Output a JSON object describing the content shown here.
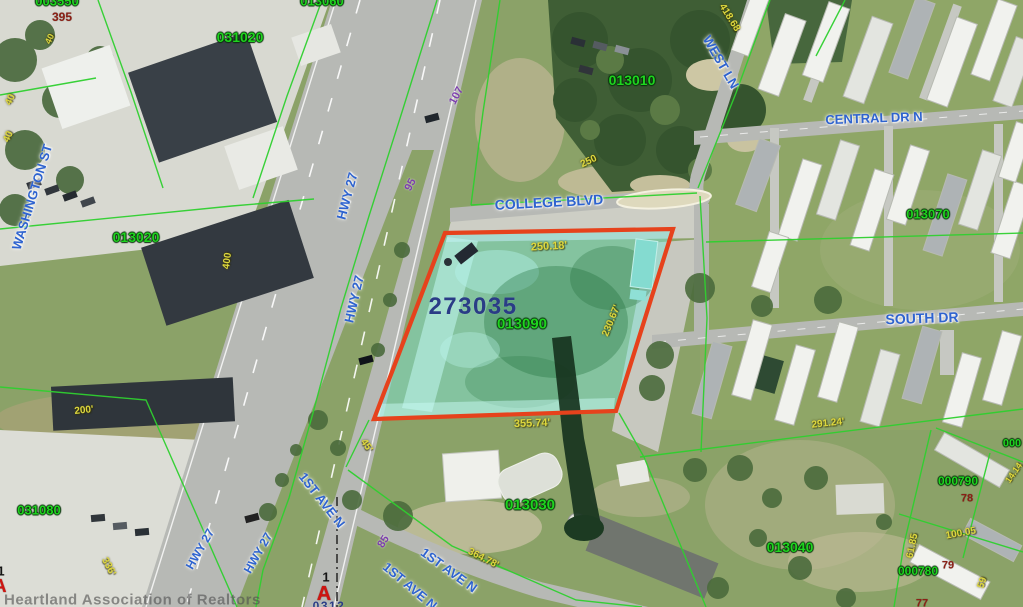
{
  "map": {
    "highlight": {
      "outline_color": "#e6421c",
      "fill_color": "rgba(125,232,220,0.48)",
      "boundary_line_color": "#2fd02f"
    },
    "labels": [
      {
        "name": "parcel-id-003550",
        "text": "003550",
        "x": 57,
        "y": 1,
        "rotate": 0,
        "color": "green",
        "size": 13
      },
      {
        "name": "lot-number-395",
        "text": "395",
        "x": 62,
        "y": 17,
        "rotate": 0,
        "color": "dark_red",
        "size": 12
      },
      {
        "name": "parcel-id-031020",
        "text": "031020",
        "x": 240,
        "y": 37,
        "rotate": 0,
        "color": "green",
        "size": 14
      },
      {
        "name": "parcel-id-013060",
        "text": "013060",
        "x": 322,
        "y": 1,
        "rotate": 0,
        "color": "green",
        "size": 13
      },
      {
        "name": "parcel-id-013010",
        "text": "013010",
        "x": 632,
        "y": 80,
        "rotate": 0,
        "color": "green",
        "size": 14
      },
      {
        "name": "street-label-washington-st",
        "text": "WASHINGTON ST",
        "x": 32,
        "y": 197,
        "rotate": -73,
        "color": "blue",
        "size": 13
      },
      {
        "name": "parcel-id-013020",
        "text": "013020",
        "x": 136,
        "y": 237,
        "rotate": 0,
        "color": "green",
        "size": 14
      },
      {
        "name": "street-label-hwy-27-1",
        "text": "HWY 27",
        "x": 347,
        "y": 196,
        "rotate": -75,
        "color": "blue",
        "size": 13
      },
      {
        "name": "street-label-hwy-27-2",
        "text": "HWY 27",
        "x": 354,
        "y": 299,
        "rotate": -77,
        "color": "blue",
        "size": 13
      },
      {
        "name": "road-dim-107",
        "text": "107",
        "x": 457,
        "y": 96,
        "rotate": -62,
        "color": "purple",
        "size": 11
      },
      {
        "name": "road-dim-95",
        "text": "95",
        "x": 411,
        "y": 185,
        "rotate": -62,
        "color": "purple",
        "size": 11
      },
      {
        "name": "street-label-college-blvd",
        "text": "COLLEGE BLVD",
        "x": 549,
        "y": 202,
        "rotate": -3,
        "color": "blue",
        "size": 14
      },
      {
        "name": "dim-250",
        "text": "250",
        "x": 589,
        "y": 162,
        "rotate": -25,
        "color": "yellow",
        "size": 10
      },
      {
        "name": "dim-418-68",
        "text": "418.68",
        "x": 729,
        "y": 18,
        "rotate": 58,
        "color": "yellow",
        "size": 10
      },
      {
        "name": "street-label-west-ln",
        "text": "WEST LN",
        "x": 721,
        "y": 62,
        "rotate": 60,
        "color": "blue",
        "size": 13
      },
      {
        "name": "street-label-central-dr-n",
        "text": "CENTRAL DR N",
        "x": 874,
        "y": 118,
        "rotate": -2,
        "color": "blue",
        "size": 13
      },
      {
        "name": "parcel-id-013070",
        "text": "013070",
        "x": 928,
        "y": 214,
        "rotate": 0,
        "color": "green",
        "size": 13
      },
      {
        "name": "street-label-south-dr",
        "text": "SOUTH DR",
        "x": 922,
        "y": 318,
        "rotate": -2,
        "color": "blue",
        "size": 14
      },
      {
        "name": "highlighted-parcel-id",
        "text": "273035",
        "x": 473,
        "y": 307,
        "rotate": 0,
        "color": "navy",
        "size": 24
      },
      {
        "name": "parcel-id-013090",
        "text": "013090",
        "x": 522,
        "y": 324,
        "rotate": 0,
        "color": "green",
        "size": 15
      },
      {
        "name": "dim-250-18",
        "text": "250.18'",
        "x": 549,
        "y": 247,
        "rotate": -3,
        "color": "yellow",
        "size": 11
      },
      {
        "name": "dim-230-67",
        "text": "230.67'",
        "x": 612,
        "y": 321,
        "rotate": -68,
        "color": "yellow",
        "size": 10
      },
      {
        "name": "dim-355-74",
        "text": "355.74'",
        "x": 532,
        "y": 424,
        "rotate": -2,
        "color": "yellow",
        "size": 11
      },
      {
        "name": "dim-45",
        "text": "45'",
        "x": 366,
        "y": 446,
        "rotate": 55,
        "color": "yellow",
        "size": 10
      },
      {
        "name": "parcel-id-013030",
        "text": "013030",
        "x": 530,
        "y": 505,
        "rotate": 0,
        "color": "green",
        "size": 15
      },
      {
        "name": "dim-364-78",
        "text": "364.78'",
        "x": 483,
        "y": 559,
        "rotate": 27,
        "color": "yellow",
        "size": 10
      },
      {
        "name": "street-label-1st-ave-n-1",
        "text": "1ST AVE N",
        "x": 449,
        "y": 570,
        "rotate": 36,
        "color": "blue",
        "size": 13
      },
      {
        "name": "street-label-1st-ave-n-2",
        "text": "1ST AVE N",
        "x": 410,
        "y": 586,
        "rotate": 40,
        "color": "blue",
        "size": 13
      },
      {
        "name": "street-label-1st-ave-n-3",
        "text": "1ST AVE N",
        "x": 322,
        "y": 500,
        "rotate": 52,
        "color": "blue",
        "size": 13
      },
      {
        "name": "road-dim-85",
        "text": "85",
        "x": 384,
        "y": 542,
        "rotate": -58,
        "color": "purple",
        "size": 11
      },
      {
        "name": "parcel-id-031080",
        "text": "031080",
        "x": 39,
        "y": 510,
        "rotate": 0,
        "color": "green",
        "size": 13
      },
      {
        "name": "dim-200",
        "text": "200'",
        "x": 84,
        "y": 411,
        "rotate": -6,
        "color": "yellow",
        "size": 10
      },
      {
        "name": "dim-336",
        "text": "336'",
        "x": 108,
        "y": 567,
        "rotate": 62,
        "color": "yellow",
        "size": 10
      },
      {
        "name": "street-label-hwy-27-3",
        "text": "HWY 27",
        "x": 200,
        "y": 549,
        "rotate": -60,
        "color": "blue",
        "size": 12
      },
      {
        "name": "street-label-hwy-27-4",
        "text": "HWY 27",
        "x": 258,
        "y": 553,
        "rotate": -60,
        "color": "blue",
        "size": 12
      },
      {
        "name": "dim-291-24",
        "text": "291.24'",
        "x": 828,
        "y": 424,
        "rotate": -6,
        "color": "yellow",
        "size": 10
      },
      {
        "name": "parcel-id-013040",
        "text": "013040",
        "x": 790,
        "y": 547,
        "rotate": 0,
        "color": "green",
        "size": 14
      },
      {
        "name": "parcel-id-000790",
        "text": "000790",
        "x": 958,
        "y": 481,
        "rotate": 0,
        "color": "green",
        "size": 12
      },
      {
        "name": "lot-number-78",
        "text": "78",
        "x": 967,
        "y": 499,
        "rotate": 0,
        "color": "dark_red",
        "size": 11
      },
      {
        "name": "dim-100-05",
        "text": "100.05",
        "x": 961,
        "y": 534,
        "rotate": -10,
        "color": "yellow",
        "size": 10
      },
      {
        "name": "dim-61-85",
        "text": "61.85",
        "x": 913,
        "y": 546,
        "rotate": -78,
        "color": "yellow",
        "size": 10
      },
      {
        "name": "parcel-id-000780",
        "text": "000780",
        "x": 918,
        "y": 571,
        "rotate": 0,
        "color": "green",
        "size": 12
      },
      {
        "name": "lot-number-79",
        "text": "79",
        "x": 948,
        "y": 566,
        "rotate": 0,
        "color": "dark_red",
        "size": 11
      },
      {
        "name": "dim-59",
        "text": "59",
        "x": 983,
        "y": 583,
        "rotate": -72,
        "color": "yellow",
        "size": 10
      },
      {
        "name": "lot-number-77",
        "text": "77",
        "x": 922,
        "y": 604,
        "rotate": 0,
        "color": "dark_red",
        "size": 11
      },
      {
        "name": "dim-14-14",
        "text": "14.14",
        "x": 1014,
        "y": 473,
        "rotate": -55,
        "color": "yellow",
        "size": 9
      },
      {
        "name": "parcel-id-partial-right",
        "text": "000",
        "x": 1012,
        "y": 444,
        "rotate": 0,
        "color": "green",
        "size": 11
      },
      {
        "name": "dim-40-a",
        "text": "40",
        "x": 50,
        "y": 39,
        "rotate": -65,
        "color": "yellow",
        "size": 9
      },
      {
        "name": "dim-40-b",
        "text": "40",
        "x": 11,
        "y": 100,
        "rotate": -65,
        "color": "yellow",
        "size": 10
      },
      {
        "name": "dim-40-c",
        "text": "40",
        "x": 9,
        "y": 137,
        "rotate": -65,
        "color": "yellow",
        "size": 10
      },
      {
        "name": "dim-400",
        "text": "400",
        "x": 228,
        "y": 261,
        "rotate": -83,
        "color": "yellow",
        "size": 10
      },
      {
        "name": "marker-number",
        "text": "1",
        "x": 326,
        "y": 577,
        "rotate": 0,
        "color": "black",
        "size": 13
      },
      {
        "name": "marker-letter-a",
        "text": "A",
        "x": 324,
        "y": 594,
        "rotate": 0,
        "color": "marker_red",
        "size": 20,
        "interactable": true
      },
      {
        "name": "clipped-marker-number-left",
        "text": "1",
        "x": 1,
        "y": 571,
        "rotate": 0,
        "color": "black",
        "size": 13
      },
      {
        "name": "clipped-marker-letter-left",
        "text": "A",
        "x": 0,
        "y": 586,
        "rotate": 0,
        "color": "marker_red",
        "size": 18
      },
      {
        "name": "clipped-label-bottom",
        "text": "0312",
        "x": 329,
        "y": 606,
        "rotate": 0,
        "color": "navy",
        "size": 12
      },
      {
        "name": "watermark",
        "text": "Heartland Association of Realtors",
        "x": 4,
        "y": 600,
        "rotate": 0,
        "color": "watermark",
        "size": 15,
        "align": "left"
      }
    ]
  }
}
